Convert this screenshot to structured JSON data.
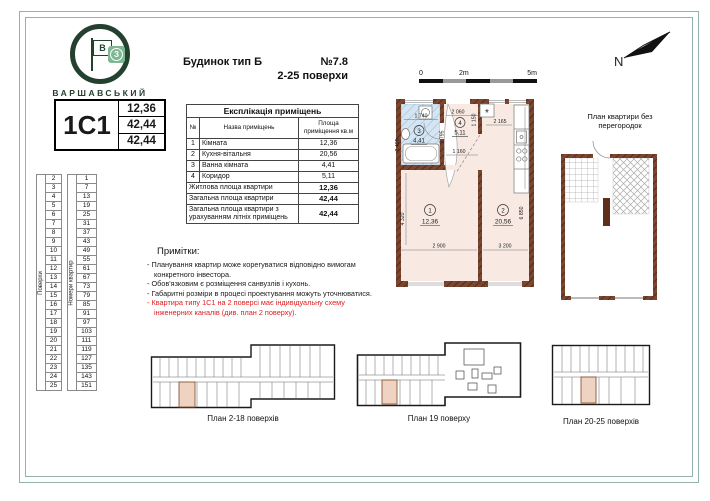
{
  "logo": {
    "brand": "ВАРШАВСЬКИЙ",
    "flag_letter": "В",
    "badge_letter": "З"
  },
  "header": {
    "building": "Будинок тип Б",
    "number": "№7.8",
    "floors": "2-25 поверхи"
  },
  "type_card": {
    "code": "1С1",
    "values": [
      "12,36",
      "42,44",
      "42,44"
    ]
  },
  "floors_table": {
    "col1_label": "Поверхи",
    "col2_label": "Номери квартир",
    "rows": [
      [
        2,
        1
      ],
      [
        3,
        7
      ],
      [
        4,
        13
      ],
      [
        5,
        19
      ],
      [
        6,
        25
      ],
      [
        7,
        31
      ],
      [
        8,
        37
      ],
      [
        9,
        43
      ],
      [
        10,
        49
      ],
      [
        11,
        55
      ],
      [
        12,
        61
      ],
      [
        13,
        67
      ],
      [
        14,
        73
      ],
      [
        15,
        79
      ],
      [
        16,
        85
      ],
      [
        17,
        91
      ],
      [
        18,
        97
      ],
      [
        19,
        103
      ],
      [
        20,
        111
      ],
      [
        21,
        119
      ],
      [
        22,
        127
      ],
      [
        23,
        135
      ],
      [
        24,
        143
      ],
      [
        25,
        151
      ]
    ]
  },
  "explication": {
    "title": "Експлікація приміщень",
    "headers": [
      "№",
      "Назва приміщень",
      "Площа приміщення кв.м"
    ],
    "rows": [
      [
        "1",
        "Кімната",
        "12,36"
      ],
      [
        "2",
        "Кухня-вітальня",
        "20,56"
      ],
      [
        "3",
        "Ванна кімната",
        "4,41"
      ],
      [
        "4",
        "Коридор",
        "5,11"
      ]
    ],
    "totals": [
      {
        "label": "Житлова площа квартири",
        "value": "12,36"
      },
      {
        "label": "Загальна площа квартири",
        "value": "42,44"
      },
      {
        "label": "Загальна площа квартири з урахуванням літніх приміщень",
        "value": "42,44"
      }
    ]
  },
  "notes": {
    "title": "Примітки:",
    "items": [
      {
        "text": "- Планування квартир може корегуватися відповідно вимогам конкретного інвестора.",
        "red": false
      },
      {
        "text": "- Обов'язковим є розміщення санвузлів і кухонь.",
        "red": false
      },
      {
        "text": "- Габаритні розміри в процесі проектування можуть  уточнюватися.",
        "red": false
      },
      {
        "text": "- Квартира типу 1С1 на 2 поверсі має індивідуальну схему інженерних каналів (див.  план 2 поверху).",
        "red": true
      }
    ]
  },
  "scale_bar": {
    "labels": [
      "0",
      "2m",
      "5m"
    ]
  },
  "north": {
    "label": "N"
  },
  "main_plan": {
    "rooms": {
      "room1": {
        "num": "1",
        "area": "12,36"
      },
      "room2": {
        "num": "2",
        "area": "20,56"
      },
      "room3": {
        "num": "3",
        "area": "4,41"
      },
      "room4": {
        "num": "4",
        "area": "5,11"
      }
    },
    "dims": {
      "bath_w": "1 740",
      "bath_h": "2 405",
      "hall_top": "2 060",
      "hall_h": "2 795",
      "hall_bottom": "1 160",
      "entry_h": "1 150",
      "kitchen_top": "2 165",
      "room1_w": "2 900",
      "room1_h": "4 320",
      "room2_w": "3 200",
      "room2_h": "6 850"
    },
    "vent_symbol": "*"
  },
  "no_partitions_plan": {
    "label": "План квартири без перегородок"
  },
  "floor_plans": [
    {
      "label": "План 2-18 поверхів"
    },
    {
      "label": "План 19 поверху"
    },
    {
      "label": "План 20-25 поверхів"
    }
  ],
  "colors": {
    "brand_green": "#24402f",
    "badge_green": "#7cb893",
    "wall_brown": "#7a4630",
    "room_fill": "#f8eae3",
    "bath_blue": "#d5e5f2",
    "highlight_unit": "#eed3c3",
    "note_red": "#e01b1b",
    "frame_teal": "#93b1ad"
  }
}
